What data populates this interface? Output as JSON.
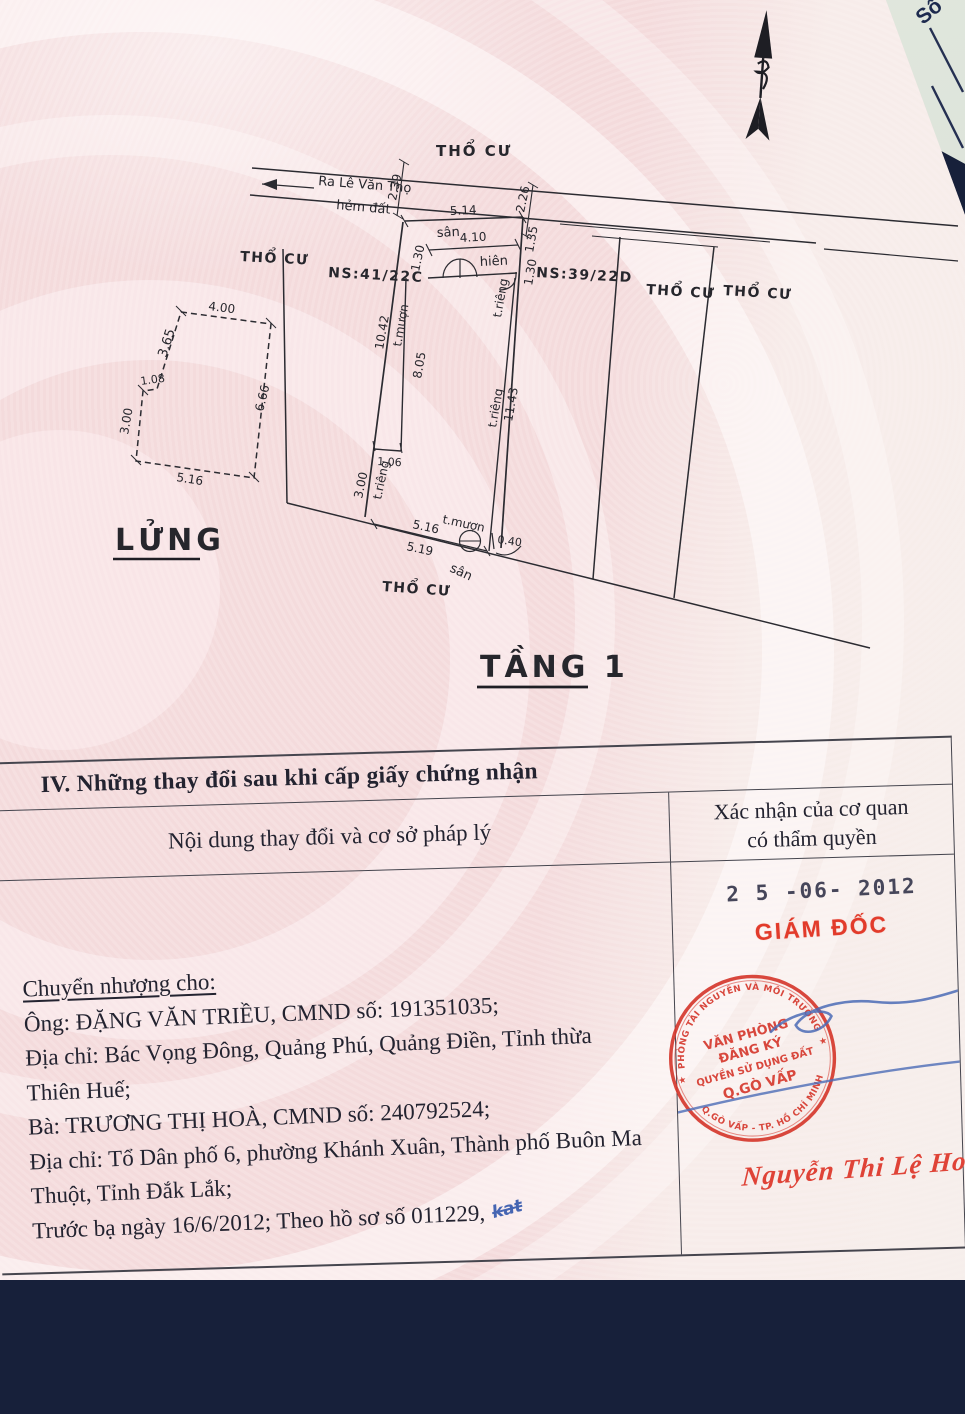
{
  "corner": {
    "so_label": "Số"
  },
  "plan": {
    "street": {
      "direction_label": "Ra Lê Văn Thọ",
      "alley_label": "hẻm đất",
      "dim_left": "2.39",
      "dim_right": "2.26"
    },
    "parcels": {
      "tho_cu_top": "THỔ CƯ",
      "tho_cu_left": "THỔ CƯ",
      "ns_left": "NS:41/22C",
      "ns_right": "NS:39/22D",
      "tho_cu_right_1": "THỔ CƯ",
      "tho_cu_right_2": "THỔ CƯ",
      "tho_cu_bottom": "THỔ CƯ"
    },
    "main": {
      "dim_top": "5.14",
      "san_top": "sân",
      "dim_porch": "4.10",
      "porch": "hiên",
      "dim_left_porch": "1.30",
      "dim_right_upper": "1.35",
      "dim_right_lower": "1.30",
      "dim_left_side": "10.42",
      "t_muon_left": "t.mượn",
      "dim_inner_wall": "8.05",
      "t_rieng_upper": "t.riêng",
      "t_rieng_right": "t.riêng",
      "dim_right_side": "11.43",
      "dim_step": "1.06",
      "dim_left_lower": "3.00",
      "t_rieng_lower": "t.riêng",
      "dim_bottom_inner": "5.16",
      "t_muon_bottom": "t.mượn",
      "dim_bottom_outer": "5.19",
      "dim_offset": "0.40",
      "san_bottom": "sân"
    },
    "mezzanine": {
      "label": "LỬNG",
      "dim_top": "4.00",
      "dim_left_upper": "3.65",
      "dim_step": "1.08",
      "dim_left_lower": "3.00",
      "dim_bottom": "5.16",
      "dim_right": "6.66"
    },
    "floor_title": "TẦNG 1"
  },
  "section4": {
    "title": "IV. Những thay đổi sau khi cấp giấy chứng nhận",
    "columns": {
      "left": "Nội dung thay đổi và cơ sở pháp lý",
      "right_line1": "Xác nhận của cơ quan",
      "right_line2": "có thẩm quyền"
    },
    "content": {
      "lines": [
        "Chuyển nhượng cho:",
        "Ông: ĐẶNG VĂN TRIỀU, CMND số: 191351035;",
        "Địa chỉ: Bác Vọng Đông, Quảng Phú, Quảng Điền, Tỉnh thừa",
        "Thiên Huế;",
        "Bà: TRƯƠNG THỊ HOÀ, CMND số: 240792524;",
        "Địa chỉ: Tổ Dân phố 6, phường Khánh Xuân, Thành phố Buôn Ma",
        "Thuột, Tỉnh Đắk Lắk;",
        "Trước bạ ngày 16/6/2012; Theo hồ sơ số 011229,"
      ],
      "pen_note": "kat"
    },
    "approval": {
      "date_stamp": "2 5 -06- 2012",
      "director_title": "GIÁM ĐỐC",
      "stamp": {
        "star": "★",
        "arc_top": "PHÒNG TÀI NGUYÊN VÀ MÔI TRƯỜNG",
        "arc_bottom": "Q.GÒ VẤP - TP. HỒ CHÍ MINH",
        "line1": "VĂN PHÒNG",
        "line2": "ĐĂNG KÝ",
        "line3": "QUYỀN SỬ DỤNG ĐẤT",
        "line4": "Q.GÒ VẤP"
      },
      "signature": "Nguyễn Thi Lệ Hoa"
    }
  }
}
